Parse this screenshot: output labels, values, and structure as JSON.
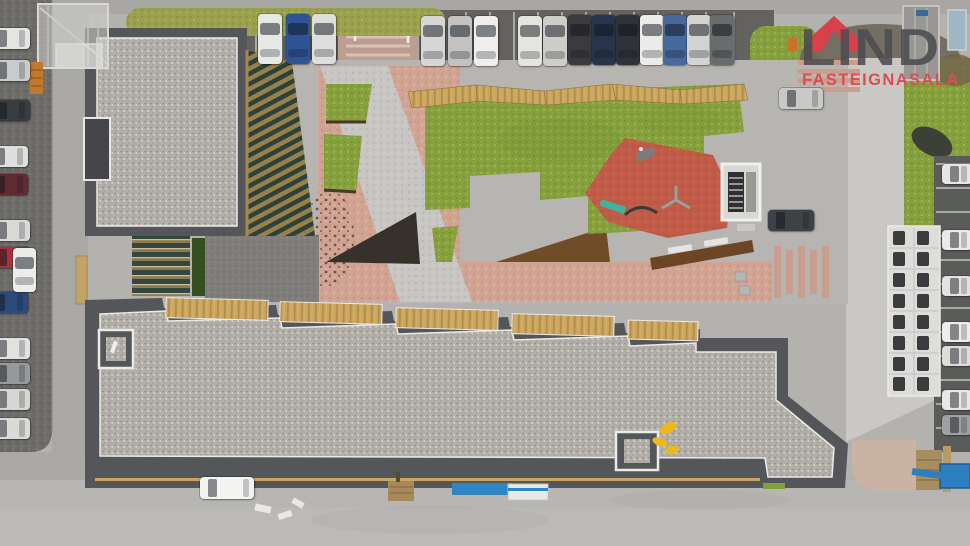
{
  "branding": {
    "name": "LIND",
    "subtitle": "FASTEIGNASALA",
    "wordmark_color": "#4d4d50",
    "subtitle_color": "#d84e55",
    "roof_icon_color": "#d8404a"
  },
  "scene": {
    "description": "Top-down aerial drone photo of a modern apartment complex: two dark-edged gravel flat roofs with balcony decks, a landscaped courtyard with lawns, salmon and grey paving, corten planters and a red rubber playground, surrounded by streets and car parks full of cars",
    "areas": {
      "upper_building": "gravel-roof apartment wing",
      "lower_building": "gravel-roof apartment wing with wooden balcony decks",
      "courtyard_lawn": "courtyard lawn",
      "playground": "red rubber playground with play equipment",
      "planters": "corten steel planters and hedges",
      "pink_plaza": "salmon paver plaza",
      "grey_plaza": "concrete paver plaza",
      "equipment_pad": "white pad with two rows of utility units",
      "parking": "perimeter parking lots"
    },
    "palette": {
      "ground": "#b3b2af",
      "road": "#a9a8a5",
      "parking_asphalt": "#63625f",
      "roof_gravel": "#b2afa8",
      "roof_slate_edge": "#54565a",
      "trim_white": "#eceae6",
      "lawn_green": "#86a03d",
      "grass_olive": "#9aa04e",
      "paving_pink": "#d0a392",
      "playground_red": "#c05b48",
      "corten_rust": "#6e4a26",
      "deck_wood": "#c9a55e",
      "facade_bronze": "#97804a"
    },
    "cars": {
      "top_row": [
        {
          "x": 258,
          "y": 14,
          "color": "#e8e8e6"
        },
        {
          "x": 286,
          "y": 14,
          "color": "#2f5496"
        },
        {
          "x": 312,
          "y": 14,
          "color": "#dededc"
        },
        {
          "x": 421,
          "y": 16,
          "color": "#d7d6d4"
        },
        {
          "x": 448,
          "y": 16,
          "color": "#c3c2c0"
        },
        {
          "x": 474,
          "y": 16,
          "color": "#efeeec"
        },
        {
          "x": 518,
          "y": 16,
          "color": "#e6e4e1"
        },
        {
          "x": 543,
          "y": 16,
          "color": "#cfcdca"
        },
        {
          "x": 568,
          "y": 15,
          "color": "#3b3b3d"
        },
        {
          "x": 592,
          "y": 15,
          "color": "#27344b"
        },
        {
          "x": 616,
          "y": 15,
          "color": "#2f3338"
        },
        {
          "x": 640,
          "y": 15,
          "color": "#ebebe9"
        },
        {
          "x": 663,
          "y": 15,
          "color": "#48699c"
        },
        {
          "x": 687,
          "y": 15,
          "color": "#d3d3d1"
        },
        {
          "x": 710,
          "y": 15,
          "color": "#696b6d"
        }
      ],
      "left_column": [
        {
          "x": -10,
          "y": 28,
          "color": "#e4e4e2"
        },
        {
          "x": -10,
          "y": 60,
          "color": "#c9cbcd"
        },
        {
          "x": -10,
          "y": 100,
          "color": "#393c41"
        },
        {
          "x": -12,
          "y": 146,
          "color": "#dfdfdd"
        },
        {
          "x": -12,
          "y": 174,
          "color": "#5f2b31"
        },
        {
          "x": -10,
          "y": 220,
          "color": "#d9d9d7"
        },
        {
          "x": -10,
          "y": 247,
          "color": "#a4333c"
        },
        {
          "x": -12,
          "y": 292,
          "color": "#2c4b7c"
        },
        {
          "x": -10,
          "y": 338,
          "color": "#e1e1df"
        },
        {
          "x": -10,
          "y": 363,
          "color": "#97999b"
        },
        {
          "x": -10,
          "y": 389,
          "color": "#d6d6d4"
        },
        {
          "x": -10,
          "y": 418,
          "color": "#dadad8"
        }
      ],
      "left_angled": [
        {
          "x": 13,
          "y": 248,
          "w": 23,
          "h": 44,
          "color": "#ecedeb"
        }
      ],
      "right_top": [
        {
          "x": 779,
          "y": 88,
          "w": 44,
          "h": 21,
          "color": "#c9c9c7"
        },
        {
          "x": 768,
          "y": 210,
          "w": 46,
          "h": 21,
          "color": "#3e4145"
        }
      ],
      "right_edge": [
        {
          "x": 942,
          "y": 164,
          "w": 30,
          "h": 20,
          "color": "#e6e6e4"
        },
        {
          "x": 942,
          "y": 230,
          "w": 30,
          "h": 20,
          "color": "#eaeae8"
        },
        {
          "x": 942,
          "y": 276,
          "w": 30,
          "h": 20,
          "color": "#e2e2e0"
        },
        {
          "x": 942,
          "y": 322,
          "w": 30,
          "h": 20,
          "color": "#ededeb"
        },
        {
          "x": 942,
          "y": 346,
          "w": 30,
          "h": 20,
          "color": "#dcdcda"
        },
        {
          "x": 942,
          "y": 390,
          "w": 30,
          "h": 20,
          "color": "#e8e8e6"
        },
        {
          "x": 942,
          "y": 415,
          "w": 30,
          "h": 20,
          "color": "#9fa0a2"
        }
      ],
      "bottom_road": [
        {
          "x": 200,
          "y": 477,
          "w": 54,
          "h": 22,
          "color": "#f3f3f1"
        }
      ]
    }
  }
}
